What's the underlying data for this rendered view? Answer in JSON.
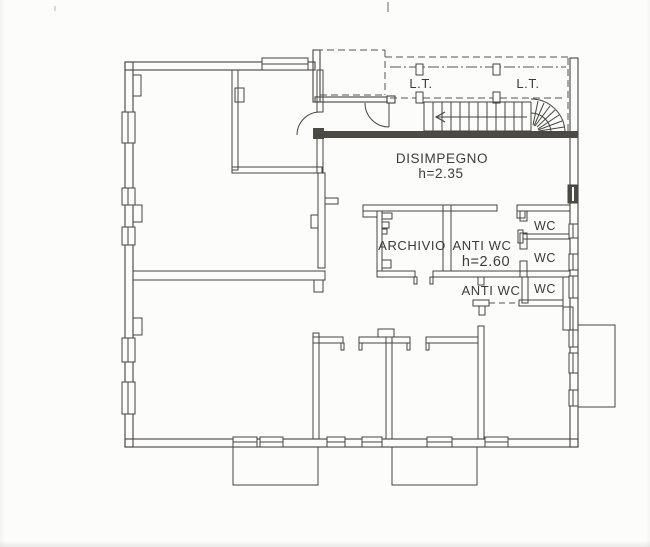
{
  "document": {
    "kind": "scanned architectural floor plan",
    "background_color": "#fcfcfa",
    "ink_color": "#45443f"
  },
  "floorplan": {
    "rooms": [
      {
        "id": "lt_left",
        "label": "L.T."
      },
      {
        "id": "lt_right",
        "label": "L.T."
      },
      {
        "id": "disimpegno",
        "label": "DISIMPEGNO",
        "height_note": "h=2.35"
      },
      {
        "id": "archivio",
        "label": "ARCHIVIO"
      },
      {
        "id": "anti_wc_upper",
        "label": "ANTI WC",
        "height_note": "h=2.60"
      },
      {
        "id": "wc_top",
        "label": "WC"
      },
      {
        "id": "wc_middle",
        "label": "WC"
      },
      {
        "id": "anti_wc_lower",
        "label": "ANTI WC"
      },
      {
        "id": "wc_lower",
        "label": "WC"
      }
    ],
    "labels": {
      "lt_left": "L.T.",
      "lt_right": "L.T.",
      "disimpegno": "DISIMPEGNO",
      "disimpegno_height": "h=2.35",
      "archivio": "ARCHIVIO",
      "anti_wc_upper": "ANTI WC",
      "anti_wc_height": "h=2.60",
      "wc_top": "WC",
      "wc_middle": "WC",
      "anti_wc_lower": "ANTI WC",
      "wc_lower": "WC"
    }
  }
}
